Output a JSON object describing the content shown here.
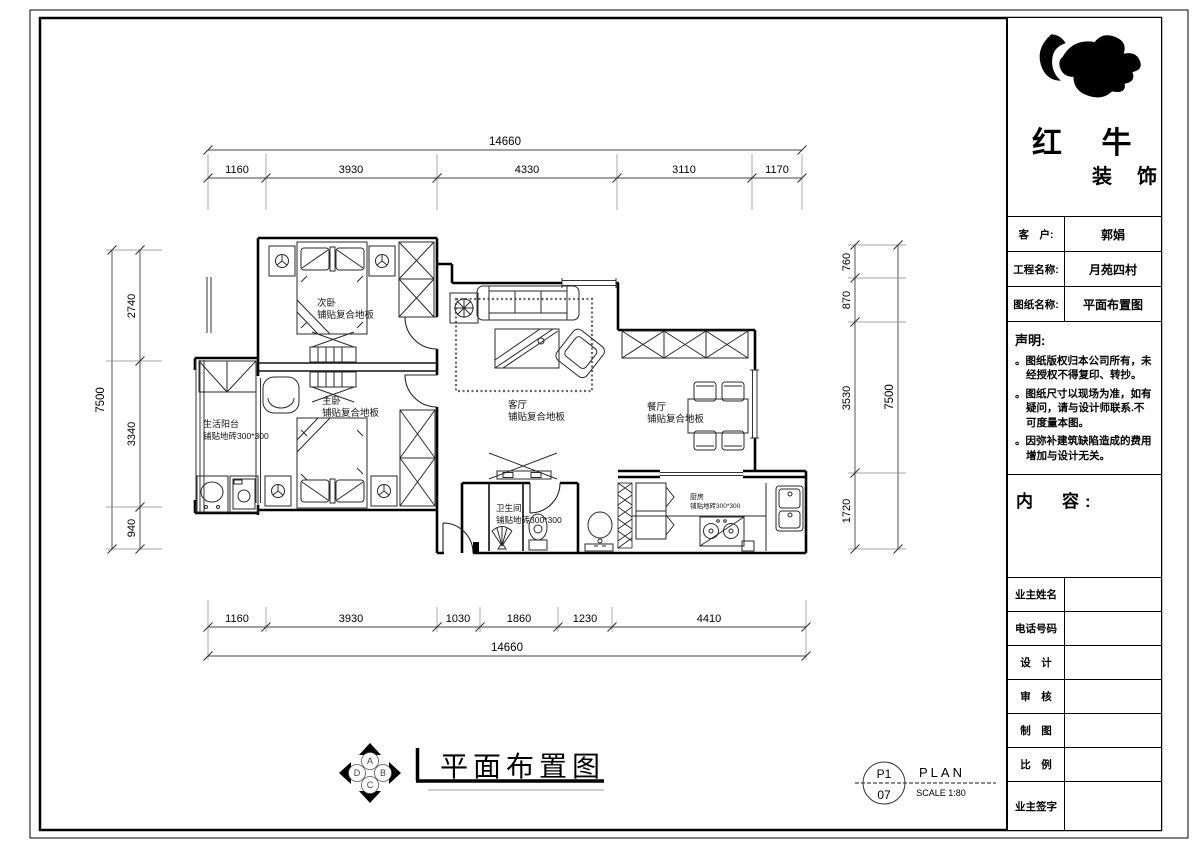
{
  "title_block": {
    "brand": {
      "name_large": "红 牛",
      "name_small": "装 饰"
    },
    "fields": [
      {
        "label": "客　户:",
        "value": "郭娟"
      },
      {
        "label": "工程名称:",
        "value": "月苑四村"
      },
      {
        "label": "图纸名称:",
        "value": "平面布置图"
      }
    ],
    "statement": {
      "heading": "声明:",
      "items": [
        "。图纸版权归本公司所有，未经授权不得复印、转抄。",
        "。图纸尺寸以现场为准，如有疑问，请与设计师联系.不可度量本图。",
        "。因弥补建筑缺陷造成的费用增加与设计无关。"
      ]
    },
    "content_heading": "内　容:",
    "signature_rows": [
      {
        "label": "业主姓名"
      },
      {
        "label": "电话号码"
      },
      {
        "label": "设　计"
      },
      {
        "label": "审　核"
      },
      {
        "label": "制　图"
      },
      {
        "label": "比　例"
      },
      {
        "label": "业主签字"
      }
    ]
  },
  "plan": {
    "rooms": {
      "bedroom2": {
        "name": "次卧",
        "floor": "铺贴复合地板"
      },
      "bedroom1": {
        "name": "主卧",
        "floor": "铺贴复合地板"
      },
      "living": {
        "name": "客厅",
        "floor": "铺贴复合地板"
      },
      "dining": {
        "name": "餐厅",
        "floor": "铺贴复合地板"
      },
      "balcony": {
        "name": "生活阳台",
        "floor": "铺贴地砖300*300"
      },
      "bathroom": {
        "name": "卫生间",
        "floor": "铺贴地砖300*300"
      },
      "kitchen": {
        "name": "厨房",
        "floor": "铺贴地砖300*300"
      }
    },
    "dims": {
      "top_total": "14660",
      "top": [
        "1160",
        "3930",
        "4330",
        "3110",
        "1170"
      ],
      "bottom": [
        "1160",
        "3930",
        "1030",
        "1860",
        "1230",
        "4410"
      ],
      "bottom_total": "14660",
      "left_total": "7500",
      "left": [
        "2740",
        "3340",
        "940"
      ],
      "right": [
        "760",
        "870",
        "3530",
        "1720"
      ],
      "right_total": "7500"
    }
  },
  "footer": {
    "drawing_title": "平面布置图",
    "compass": {
      "top": "A",
      "right": "B",
      "bottom": "C",
      "left": "D"
    },
    "sheet_ref": {
      "code": "P1",
      "page": "07",
      "kind": "PLAN",
      "scale": "SCALE 1:80"
    }
  }
}
